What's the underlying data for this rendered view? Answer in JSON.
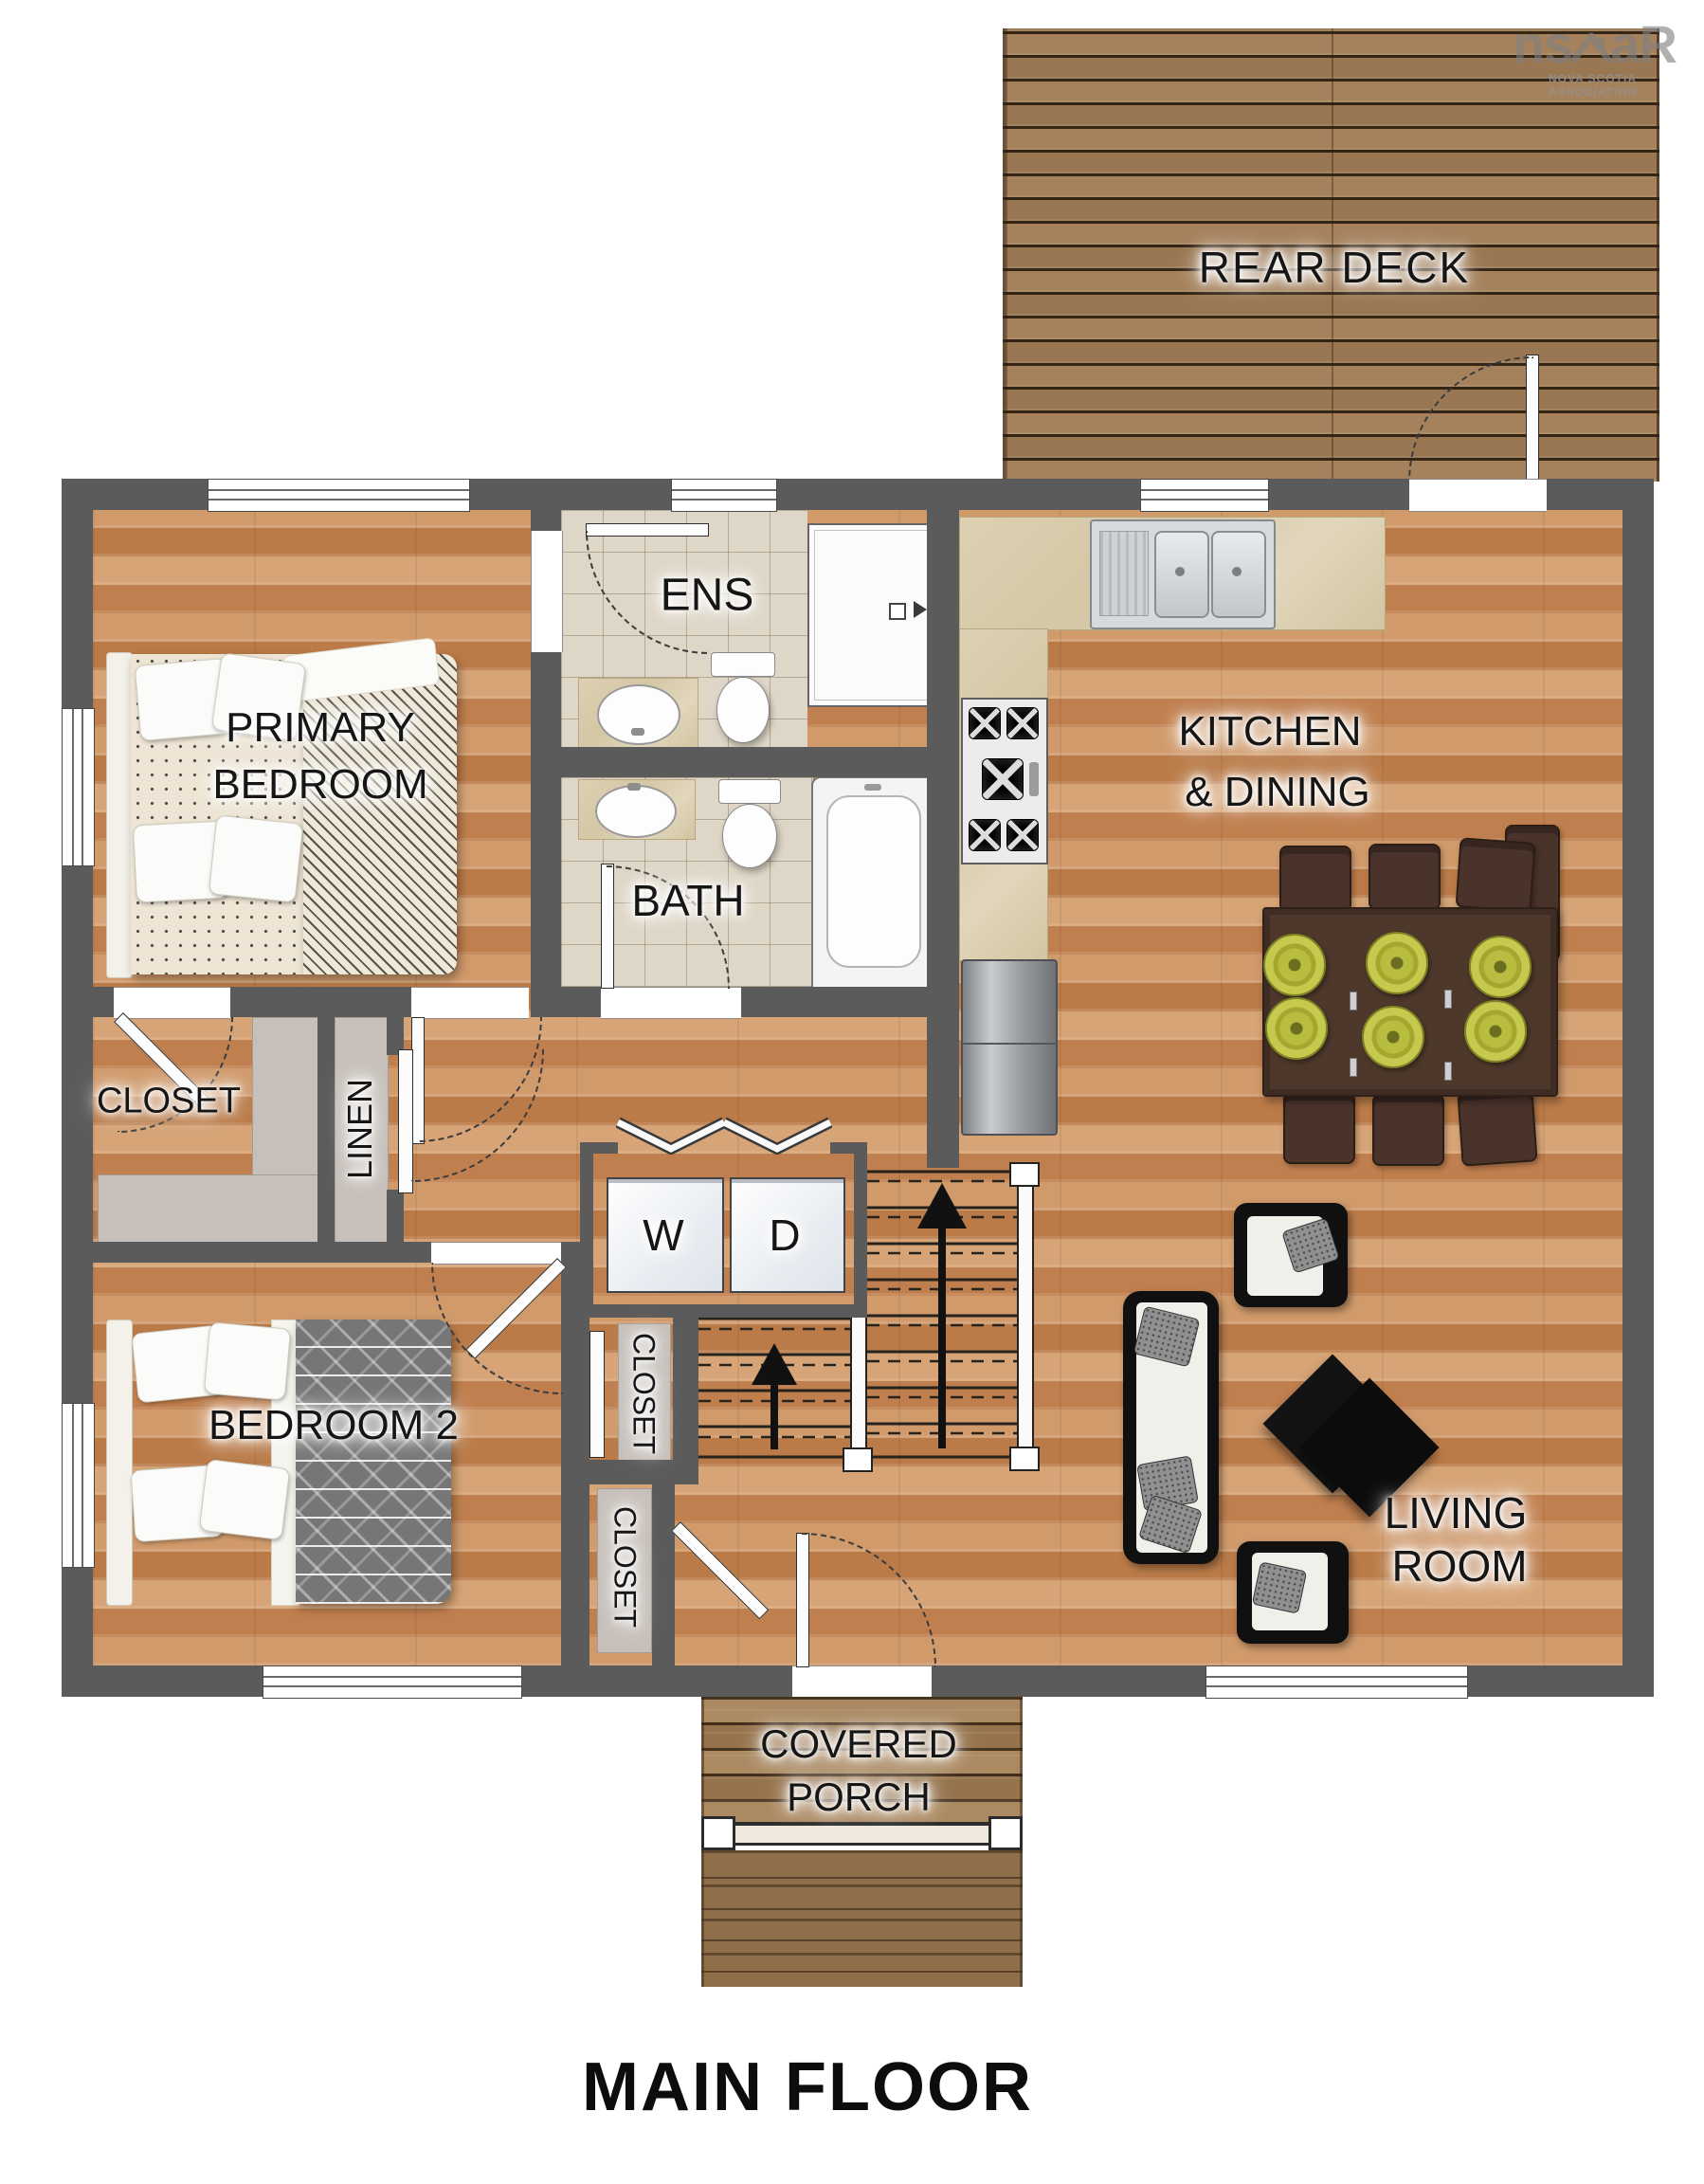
{
  "page": {
    "background": "#ffffff"
  },
  "watermark": {
    "logo_left": "ns",
    "logo_right": "aR",
    "org": "NOVA SCOTIA ASSOCIATION"
  },
  "labels": {
    "rear_deck": "REAR DECK",
    "primary_bedroom": [
      "PRIMARY",
      "BEDROOM"
    ],
    "ens": "ENS",
    "kitchen_dining": [
      "KITCHEN",
      "& DINING"
    ],
    "bath": "BATH",
    "primary_closet": "CLOSET",
    "linen": "LINEN",
    "washer": "W",
    "dryer": "D",
    "bedroom_2": "BEDROOM 2",
    "hall_closet_upper": "CLOSET",
    "hall_closet_lower": "CLOSET",
    "living_room": [
      "LIVING",
      "ROOM"
    ],
    "covered_porch": [
      "COVERED",
      "PORCH"
    ],
    "floor_title": "MAIN FLOOR"
  },
  "colors": {
    "wall": "#5b5b5b",
    "wood_floor": "#c88c5c",
    "deck_wood": "#9c7a54",
    "tile": "#ded6c6",
    "counter_marble": "#d9cdab",
    "dining_table": "#4e382b",
    "plate_green": "#b9bd3f",
    "shelf_gray": "#c7c0ba",
    "furniture_black": "#111111"
  }
}
